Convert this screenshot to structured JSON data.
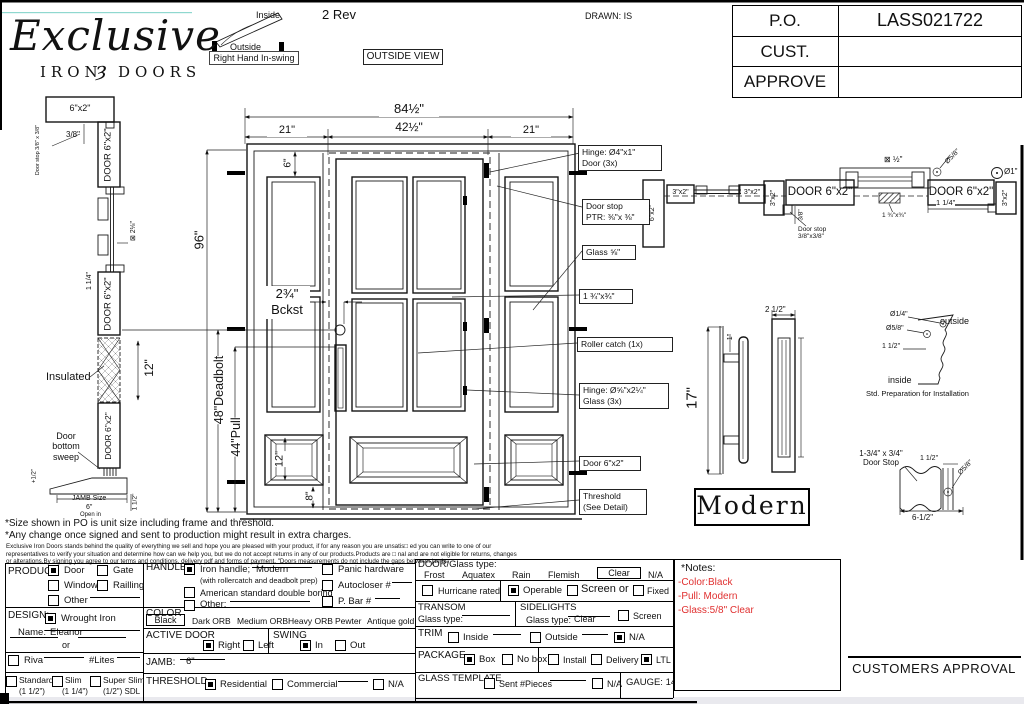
{
  "h": {
    "logo1": "Exclusive",
    "logo2": "IRON",
    "orn": "ȝ",
    "logo3": "DOORS",
    "inside": "Inside",
    "outside": "Outside",
    "swing": "Right Hand In-swing",
    "rev": "2 Rev",
    "view": "OUTSIDE VIEW",
    "drawn": "DRAWN: IS",
    "po_l": "P.O.",
    "po_v": "LASS021722",
    "cust_l": "CUST.",
    "cust_v": "",
    "app_l": "APPROVE",
    "app_v": ""
  },
  "ls": {
    "jamb": "6\"x2\"",
    "d38": "3/8\"",
    "stop": "Door stop\n3/8\" x 3/8\"",
    "door": "DOOR 6\"x2\"",
    "glass": "⊠ 2⅛\"",
    "d114": "1 1/4\"",
    "ins": "Insulated",
    "d12": "12\"",
    "sweep": "Door\nbottom\nsweep",
    "half": "+1/2\"",
    "js": "JAMB Size",
    "j6": "6\"",
    "oi": "Open in",
    "d112": "1 1/2\""
  },
  "el": {
    "w": "84½\"",
    "w1": "21\"",
    "w2": "42½\"",
    "w3": "21\"",
    "hh": "96\"",
    "d6": "6\"",
    "bk": "2¾\"\nBckst",
    "db": "48\"Deadbolt",
    "pl": "44\"Pull",
    "d12": "12\"",
    "d8": "8\""
  },
  "call": [
    "Hinge: Ø4\"x1\"\nDoor (3x)",
    "Door stop\nPTR: ⅜\"x ⅜\"",
    "Glass ⅝\"",
    "1 ¾\"x¾\"",
    "Roller catch  (1x)",
    "Hinge: Ø⅝\"x2¼\"\nGlass (3x)",
    "Door 6\"x2\"",
    "Threshold\n(See Detail)"
  ],
  "pln": {
    "a": "6\"x2\"",
    "b": "3\"x2\"",
    "c": "3\"x2\"",
    "d": "3\"x2\"",
    "e": "DOOR 6\"x2\"",
    "f": "DOOR 6\"x2\"",
    "g": "3\"x2\"",
    "d38": "3/8\"",
    "stop": "Door stop\n3/8\"x3/8\"",
    "gl": "⊠ ½\"",
    "o58": "Ø5/8\"",
    "d114": "1 1/4\"",
    "s134": "1 ¾\"x¾\"",
    "o1": "Ø1\""
  },
  "dt": {
    "d17": "17\"",
    "d1": "1\"",
    "d25": "2 1/2\"",
    "modern": "Modern",
    "o14": "Ø1/4\"",
    "o58": "Ø5/8\"",
    "d112": "1 1/2\"",
    "out": "outside",
    "ins": "inside",
    "cap": "Std. Preparation for Installation",
    "ds1": "1-3/4\" x 3/4\"\nDoor Stop",
    "ds3": "1 1/2\"",
    "ds4": "Ø5/8\"",
    "ds5": "6-1/2\""
  },
  "dc": {
    "l1": "*Size shown in PO is unit size including frame and threshold.",
    "l2": "*Any change once signed and sent to production might result in extra charges.",
    "s1": "Exclusive Iron Doors stands behind the quality of everything we sell and hope you are pleased with your product, if for any reason you are unsatis□ ed you can write to one of our",
    "s2": "representatives to verify your situation and determine how can we help you, but we do not accept returns in any of our products.Products are □ nal and are not eligible for returns, changes",
    "s3": "or alterations.By signing you agree to our terms and conditions, delivery pdf and forms of payment. \"Doors measurements do not include the gaps between jambs"
  },
  "f": {
    "prod": {
      "t": "PRODUCT:",
      "door": "Door",
      "gate": "Gate",
      "win": "Window",
      "rail": "Railling",
      "oth": "Other"
    },
    "des": {
      "t": "DESIGN:",
      "wi": "Wrought Iron",
      "nm": "Name:",
      "nv": "Eleanor",
      "or": "or",
      "riva": "Riva",
      "lites": "#Lites",
      "st": "Standard",
      "st2": "(1 1/2\")",
      "sl": "Slim",
      "sl2": "(1 1/4\")",
      "ss": "Super Slim",
      "ss2": "(1/2\") SDL"
    },
    "hd": {
      "t": "HANDLE",
      "ih": "Iron handle;",
      "ihv": "Modern",
      "sub": "(with rollercatch and deadbolt prep)",
      "am": "American standard double boring",
      "oth": "Other:",
      "pan": "Panic hardware",
      "auto": "Autocloser #",
      "pbar": "P. Bar #"
    },
    "col": {
      "t": "COLOR",
      "v": "Black",
      "o2": "Dark ORB",
      "o3": "Medium ORB",
      "o4": "Heavy ORB",
      "o5": "Pewter",
      "o6": "Antique gold"
    },
    "act": {
      "t": "ACTIVE DOOR",
      "r": "Right",
      "l": "Left"
    },
    "sw": {
      "t": "SWING",
      "i": "In",
      "o": "Out"
    },
    "jam": {
      "t": "JAMB:",
      "v": "6\""
    },
    "th": {
      "t": "THRESHOLD",
      "res": "Residential",
      "com": "Commercial",
      "na": "N/A"
    },
    "gl": {
      "t": "DOOR/Glass type:",
      "o1": "Frost",
      "o2": "Aquatex",
      "o3": "Rain",
      "o4": "Flemish",
      "o5": "Clear",
      "o6": "N/A"
    },
    "hur": {
      "h": "Hurricane rated",
      "op": "Operable",
      "sc": "Screen or",
      "fx": "Fixed"
    },
    "tr": {
      "t": "TRANSOM",
      "g": "Glass type:"
    },
    "sd": {
      "t": "SIDELIGHTS",
      "g": "Glass type:",
      "v": "Clear",
      "s": "Screen"
    },
    "tm": {
      "t": "TRIM",
      "i": "Inside",
      "o": "Outside",
      "na": "N/A"
    },
    "pk": {
      "t": "PACKAGE",
      "box": "Box",
      "nb": "No box",
      "ins": "Install",
      "del": "Delivery",
      "ltl": "LTL"
    },
    "gt": {
      "t": "GLASS TEMPLATE",
      "sent": "Sent #Pieces",
      "na": "N/A",
      "ga": "GAUGE: 14"
    }
  },
  "nt": {
    "t": "*Notes:",
    "n1": "-Color:Black",
    "n2": "-Pull: Modern",
    "n3": "-Glass:5/8\" Clear"
  },
  "ap": "CUSTOMERS APPROVAL"
}
